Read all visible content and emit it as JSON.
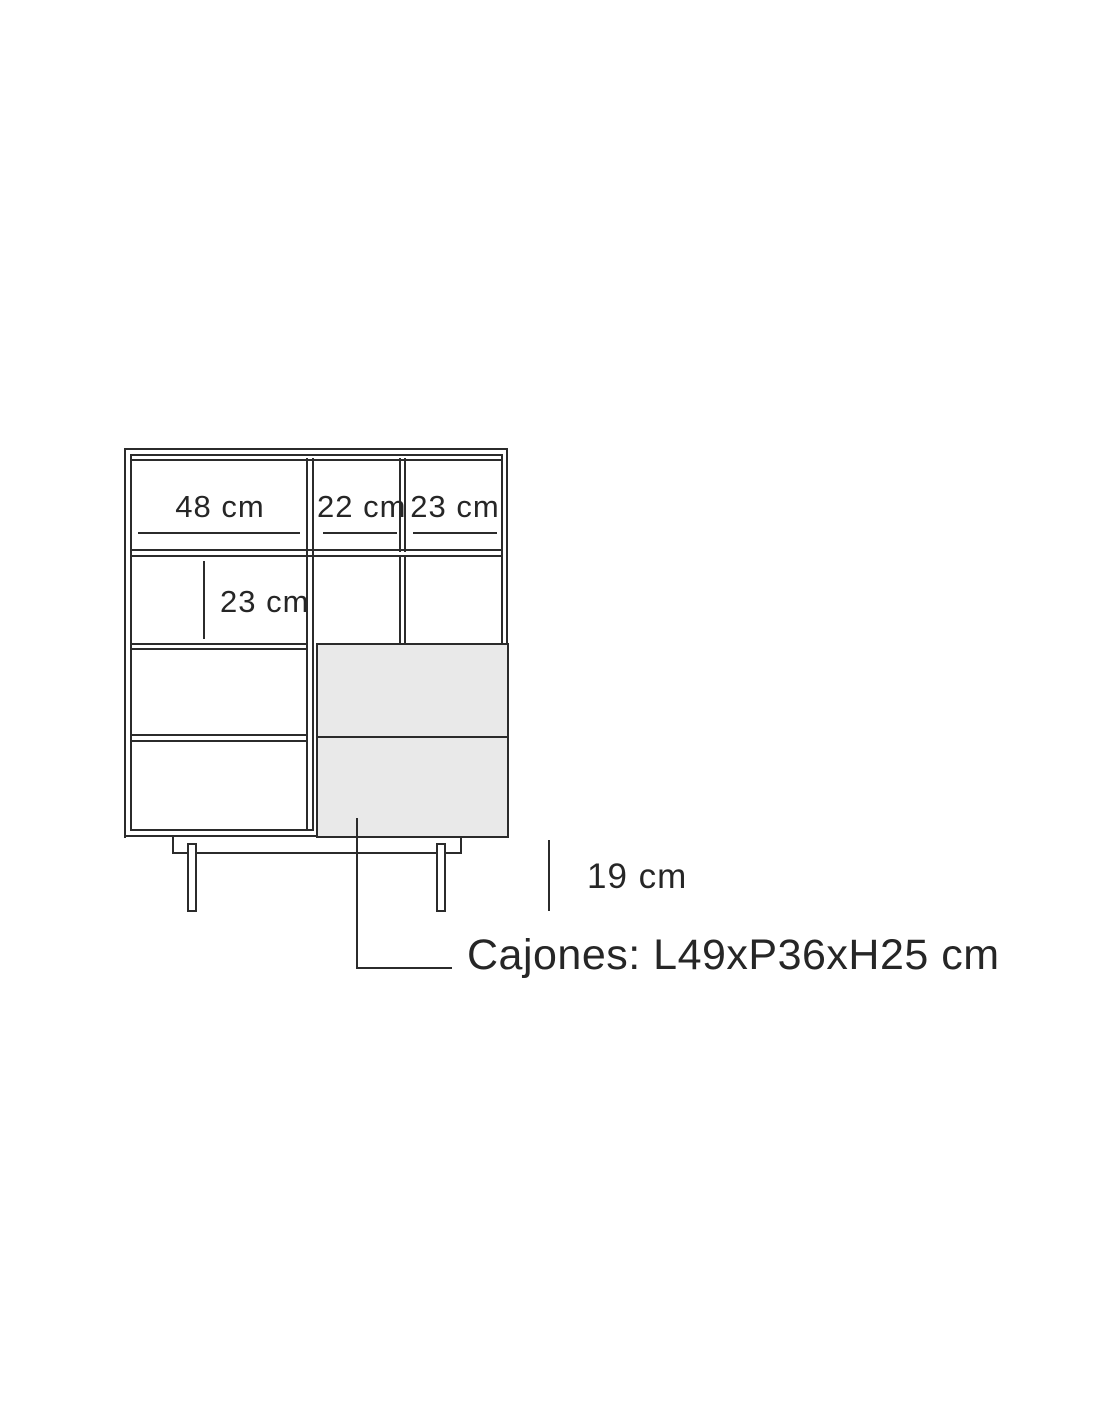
{
  "diagram": {
    "kind": "furniture-dimension-diagram",
    "labels": {
      "top_left_width": "48 cm",
      "top_middle_width": "22 cm",
      "top_right_width": "23 cm",
      "second_row_height": "23 cm",
      "leg_height": "19 cm",
      "drawers_note": "Cajones: L49xP36xH25 cm"
    },
    "colors": {
      "line": "#2b2b2b",
      "drawer_fill": "#e9e9e9",
      "background": "#ffffff",
      "text": "#262626"
    }
  }
}
